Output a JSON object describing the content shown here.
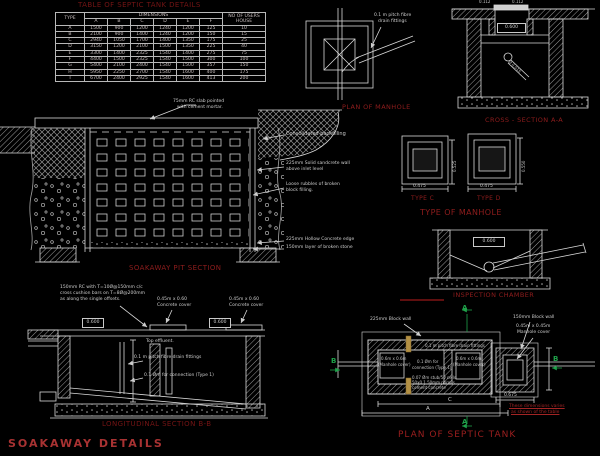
{
  "colors": {
    "background": "#000000",
    "line": "#d9d9d9",
    "hatch": "#8f8f8f",
    "caption_red": "#8f1d1d",
    "dark_red": "#741414",
    "bright_red": "#a83232",
    "green": "#1fa24a",
    "tan": "#b39044",
    "label_text": "#cdcdcd",
    "table_text": "#c7bdbd"
  },
  "titles": {
    "table": "TABLE OF SEPTIC TANK DETAILS",
    "plan_of_manhole": "PLAN OF MANHOLE",
    "cross_section": "CROSS - SECTION A-A",
    "type_c": "TYPE C",
    "type_d": "TYPE D",
    "type_of_manhole": "TYPE OF MANHOLE",
    "inspection_chamber": "INSPECTION CHAMBER",
    "soakaway_pit_section": "SOAKAWAY PIT SECTION",
    "longitudinal_section": "LONGITUDINAL SECTION B-B",
    "soakaway_details": "SOAKAWAY  DETAILS",
    "plan_of_septic_tank": "PLAN OF SEPTIC TANK"
  },
  "table": {
    "type_header": "TYPE",
    "dimensions_header": "DIMENSIONS",
    "users_header_line1": "NO OF USERS",
    "users_header_line2": "HOUSE",
    "dim_columns": [
      "A",
      "B",
      "C",
      "D",
      "E",
      "F"
    ],
    "rows": [
      {
        "type": "A",
        "dims": [
          "1500",
          "900",
          "1200",
          "1240",
          "1200",
          "125"
        ],
        "users": "10"
      },
      {
        "type": "B",
        "dims": [
          "2100",
          "900",
          "1400",
          "1240",
          "1200",
          "150"
        ],
        "users": "15"
      },
      {
        "type": "C",
        "dims": [
          "2940",
          "1050",
          "1700",
          "1400",
          "1350",
          "175"
        ],
        "users": "25"
      },
      {
        "type": "D",
        "dims": [
          "3150",
          "1200",
          "2100",
          "1500",
          "1350",
          "225"
        ],
        "users": "40"
      },
      {
        "type": "E",
        "dims": [
          "3300",
          "1400",
          "2325",
          "1540",
          "1400",
          "275"
        ],
        "users": "75"
      },
      {
        "type": "F",
        "dims": [
          "4400",
          "1500",
          "2325",
          "1540",
          "1500",
          "300"
        ],
        "users": "100"
      },
      {
        "type": "G",
        "dims": [
          "5400",
          "2100",
          "2400",
          "1540",
          "1500",
          "357"
        ],
        "users": "150"
      },
      {
        "type": "H",
        "dims": [
          "5950",
          "2250",
          "2700",
          "1540",
          "1600",
          "400"
        ],
        "users": "175"
      },
      {
        "type": "I",
        "dims": [
          "6700",
          "2400",
          "2925",
          "1540",
          "1600",
          "413"
        ],
        "users": "200"
      }
    ]
  },
  "manhole_plan": {
    "pipe_note_1": "0.1 m pitch fibre",
    "pipe_note_2": "drain fittings"
  },
  "cross_section": {
    "cover_dim_left": "0.112",
    "cover_dim_right": "0.112",
    "neck_dim": "0.600",
    "pipe_dim": "Ø 0.015"
  },
  "manhole_types": {
    "c_width": "0.475",
    "c_height": "0.525",
    "d_width": "0.475",
    "d_height": "0.550"
  },
  "inspection_chamber": {
    "top_dim": "0.600"
  },
  "soakaway": {
    "slab_note_1": "75mm RC slab pointed",
    "slab_note_2": "with cement mortar.",
    "backfill_note": "Consolidated backfilling",
    "wall_note_1": "225mm Solid sandcrete wall",
    "wall_note_2": "above inlet level",
    "rubble_note_1": "Loose rubbles of broken",
    "rubble_note_2": "block filling.",
    "edge_note": "225mm Hollow Concrete edge",
    "stone_note": "150mm layer of broken stone"
  },
  "longitudinal": {
    "slab_note_1": "150mm RC with T=10Ø@150mm c/c",
    "slab_note_2": "cross cushion bars on T=8Ø@200mm",
    "slab_note_3": "as along the single offsets.",
    "cover1_note_1": "0.45m x 0.60",
    "cover1_note_2": "Concrete cover",
    "cover2_note_1": "0.45m x 0.60",
    "cover2_note_2": "Concrete cover",
    "dim_left": "0.600",
    "dim_right": "0.600",
    "effluent_note": "Top effluent.",
    "pipe_note": "0.1 m pitch fibre drain fittings",
    "connection_note": "0.1 Øm for connection (Type 1)"
  },
  "septic_plan": {
    "wall225_note": "225mm Block wall",
    "wall150_note": "150mm Block wall",
    "mh45_note_1": "0.45m x 0.45m",
    "mh45_note_2": "Manhole cover",
    "mh60a_note_1": "0.6m x 0.6m",
    "mh60a_note_2": "(Manhole cover)",
    "mh60b_note_1": "0.6m x 0.6m",
    "mh60b_note_2": "(Manhole cover)",
    "pitch_note": "0.1 m pitch fibre drain fittings",
    "connection_note_1": "0.1 Øm for",
    "connection_note_2": "connection (Type 1)",
    "porous_note_1": "0.07 Øm stub/50 cells",
    "porous_note_2": "50x0.1 50mm porous",
    "porous_note_3": "cement concrete",
    "dim_0675": "0.675",
    "dim_a": "A",
    "dim_c": "C",
    "marker_a_top": "A",
    "marker_a_bottom": "A",
    "marker_b_left": "B",
    "marker_b_right": "B",
    "red_note_1": "These dimensions varies",
    "red_note_2": "as shown of the table"
  }
}
